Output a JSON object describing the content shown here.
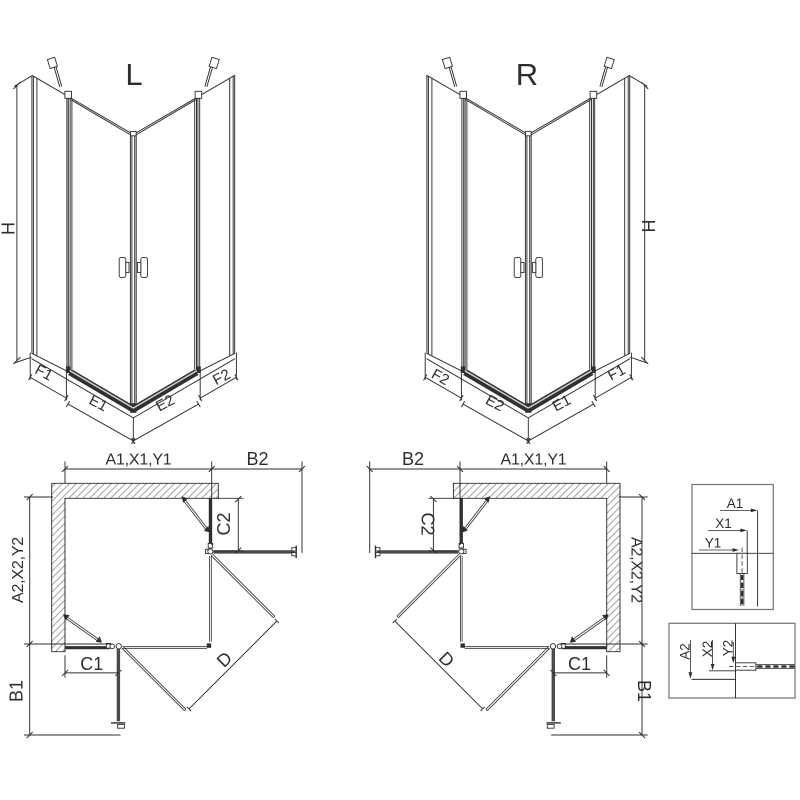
{
  "colors": {
    "line": "#2d2d2d",
    "panel": "#303030",
    "side_panel": "#4a4a4a",
    "hatch": "#999999",
    "sill_highlight": "#cccccc",
    "detail_border": "#767676"
  },
  "perspective_left": {
    "title": "L",
    "height": "H",
    "f1": "F1",
    "e1": "E1",
    "e2": "E2",
    "f2": "F2"
  },
  "perspective_right": {
    "title": "R",
    "height": "H",
    "f1": "F1",
    "e1": "E1",
    "e2": "E2",
    "f2": "F2"
  },
  "plan_left": {
    "width_top": "A1,X1,Y1",
    "side_top": "B2",
    "depth_left": "A2,X2,Y2",
    "fixed_right": "C2",
    "fixed_bottom": "C1",
    "side_left": "B1",
    "door": "D"
  },
  "plan_right": {
    "width_top": "A1,X1,Y1",
    "side_top": "B2",
    "depth_right": "A2,X2,Y2",
    "fixed_left": "C2",
    "fixed_bottom": "C1",
    "side_right": "B1",
    "door": "D"
  },
  "detail_top": {
    "a1": "A1",
    "x1": "X1",
    "y1": "Y1"
  },
  "detail_bottom": {
    "a2": "A2",
    "x2": "X2",
    "y2": "Y2"
  }
}
